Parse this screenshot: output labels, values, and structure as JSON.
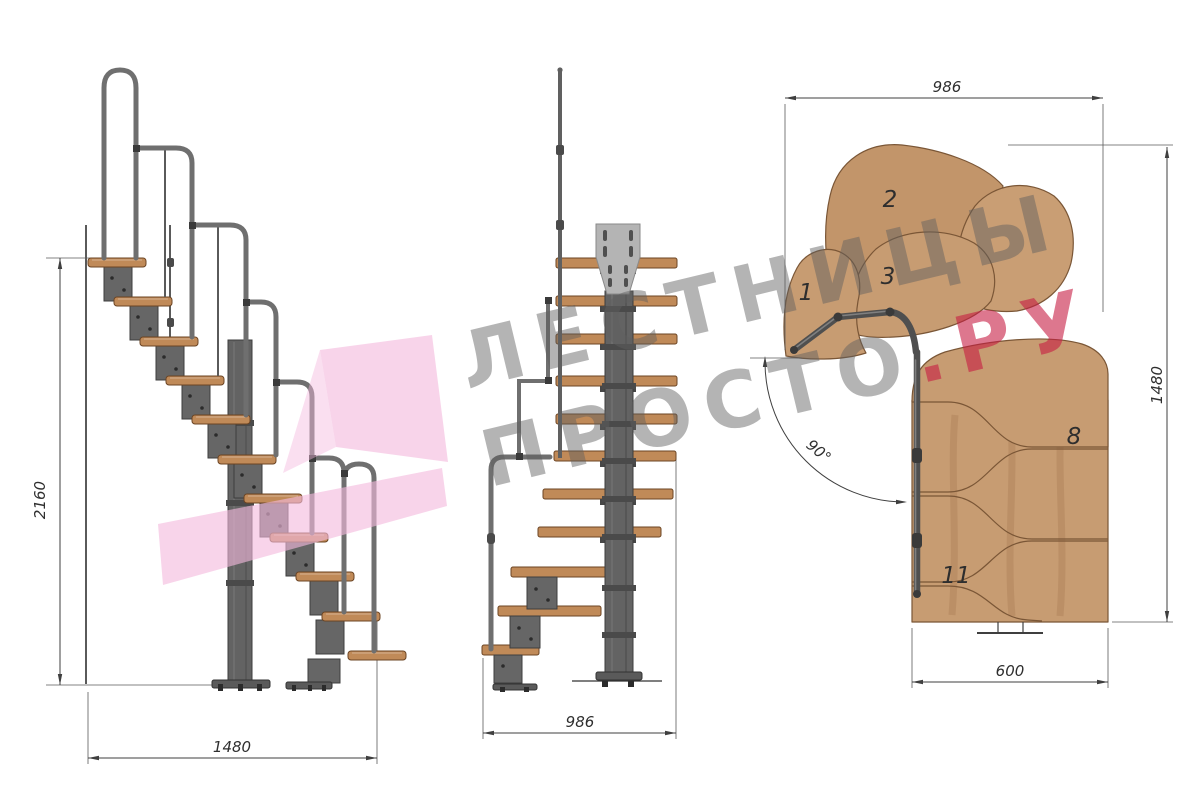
{
  "watermark": {
    "line1": "ЛЕСТНИЦЫ",
    "line2_gray": "ПРОСТО",
    "line2_accent": ".РУ",
    "gray_color": "#9b9b9b",
    "accent_color": "#d94f66",
    "arrow_color": "#f3b9dd"
  },
  "views": {
    "side": {
      "height_mm": "2160",
      "run_mm": "1480"
    },
    "front": {
      "width_mm": "986"
    },
    "plan": {
      "width_mm": "986",
      "depth_mm": "1480",
      "exit_width_mm": "600",
      "turn_angle": "90°",
      "step_numbers": [
        "1",
        "2",
        "3",
        "8",
        "11"
      ]
    }
  },
  "materials": {
    "wood_color": "#c79c72",
    "tread_color": "#c08a58",
    "metal_color": "#6f6f6f",
    "frame_color": "#666666",
    "dimension_color": "#2f2f2f"
  }
}
